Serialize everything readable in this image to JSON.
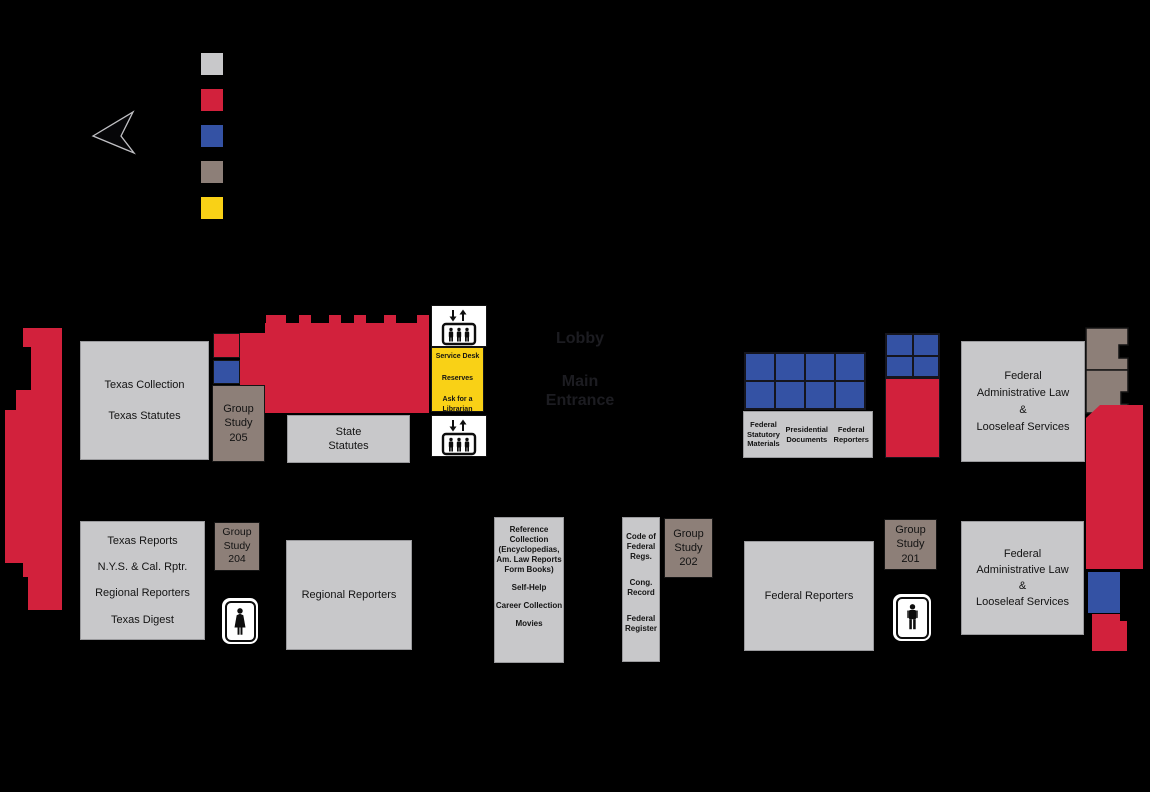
{
  "palette": {
    "gray": "#c8c8ca",
    "red": "#d2213c",
    "blue": "#3452a4",
    "brown": "#8d7f78",
    "yellow": "#f9d116",
    "ink": "#131313",
    "lobby": "#1c1c21"
  },
  "legend": {
    "swatches": [
      "gray",
      "red",
      "blue",
      "brown",
      "yellow"
    ]
  },
  "icons": {
    "compass": "pointer-arrow",
    "elevator": "elevator-up-down-people",
    "restroom_women": "woman-figure",
    "restroom_men": "man-figure"
  },
  "lobby": {
    "label": "Lobby",
    "main_line1": "Main",
    "main_line2": "Entrance"
  },
  "service_desk": {
    "lines": [
      "Service Desk",
      "Reserves",
      "Ask for a",
      "Librarian"
    ]
  },
  "rooms": {
    "texas_collection": {
      "lines": [
        "Texas Collection",
        "Texas Statutes"
      ]
    },
    "group_study_205": {
      "lines": [
        "Group",
        "Study",
        "205"
      ]
    },
    "state_statutes": {
      "lines": [
        "State",
        "Statutes"
      ]
    },
    "federal_statutory_materials": {
      "lines": [
        "Federal",
        "Statutory",
        "Materials"
      ]
    },
    "presidential_documents": {
      "lines": [
        "Presidential",
        "Documents"
      ]
    },
    "federal_reporters_north": {
      "lines": [
        "Federal",
        "Reporters"
      ]
    },
    "federal_admin_north": {
      "lines": [
        "Federal",
        "Administrative Law",
        "&",
        "Looseleaf Services"
      ]
    },
    "texas_reports": {
      "lines": [
        "Texas Reports",
        "N.Y.S. & Cal. Rptr.",
        "Regional Reporters",
        "Texas Digest"
      ]
    },
    "group_study_204": {
      "lines": [
        "Group",
        "Study",
        "204"
      ]
    },
    "regional_reporters": {
      "label": "Regional Reporters"
    },
    "reference_collection": {
      "lines": [
        "Reference",
        "Collection",
        "(Encyclopedias,",
        "Am. Law Reports",
        "Form Books)",
        "Self-Help",
        "Career Collection",
        "Movies"
      ]
    },
    "code_of_federal": {
      "lines": [
        "Code of",
        "Federal",
        "Regs.",
        "Cong.",
        "Record",
        "Federal",
        "Register"
      ]
    },
    "group_study_202": {
      "lines": [
        "Group",
        "Study",
        "202"
      ]
    },
    "federal_reporters_south": {
      "label": "Federal Reporters"
    },
    "group_study_201": {
      "lines": [
        "Group",
        "Study",
        "201"
      ]
    },
    "federal_admin_south": {
      "lines": [
        "Federal",
        "Administrative Law",
        "&",
        "Looseleaf Services"
      ]
    }
  }
}
